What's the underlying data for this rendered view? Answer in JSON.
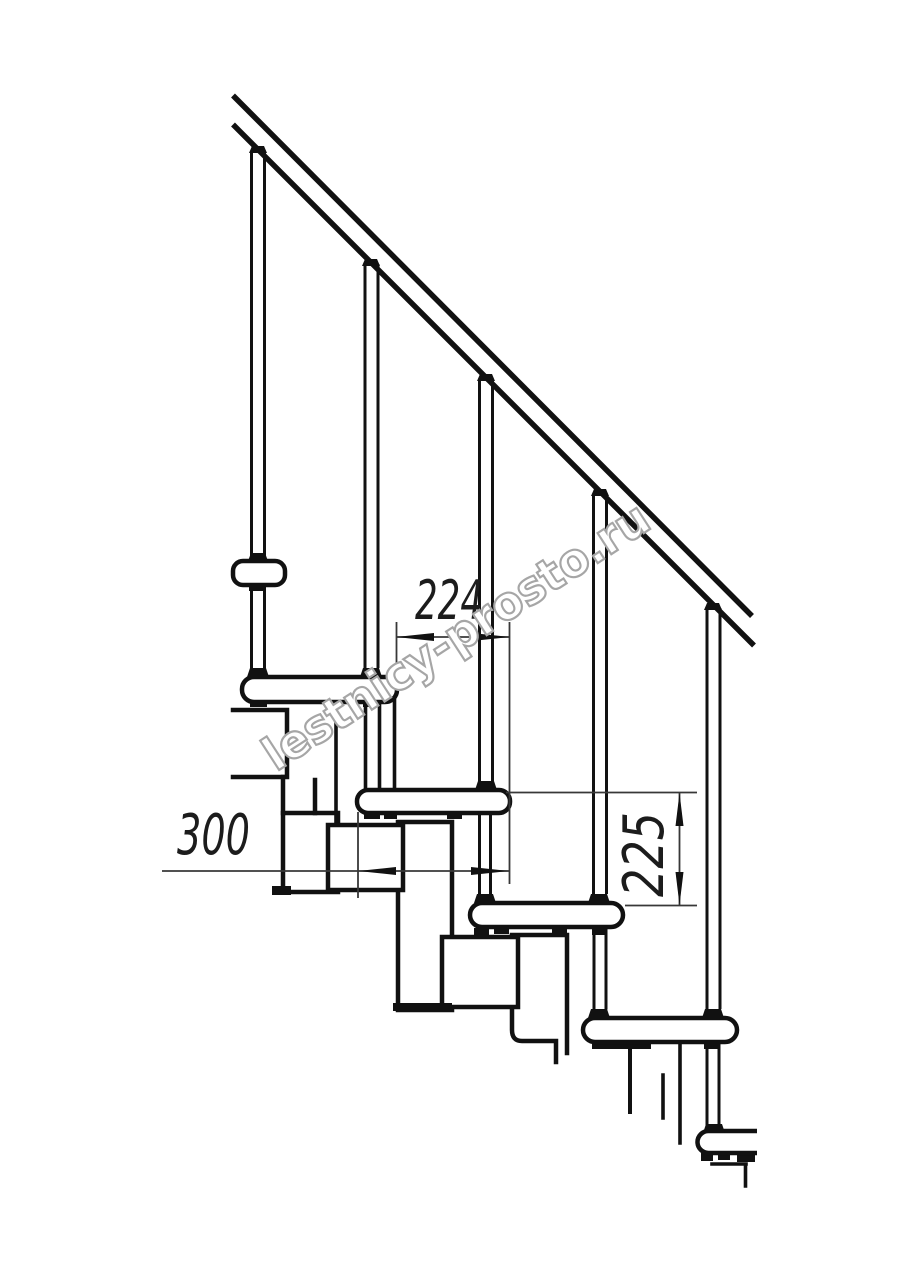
{
  "document": {
    "kind": "technical-drawing",
    "background_color": "#ffffff",
    "line_color": "#111111",
    "dim_line_color": "#383838"
  },
  "dimensions": {
    "step_run": {
      "label": "224",
      "value": 224
    },
    "tread_length": {
      "label": "300",
      "value": 300
    },
    "step_rise": {
      "label": "225",
      "value": 225
    }
  },
  "watermark": {
    "text": "lestnicy-prosto.ru",
    "color": "#a6a6a6"
  }
}
